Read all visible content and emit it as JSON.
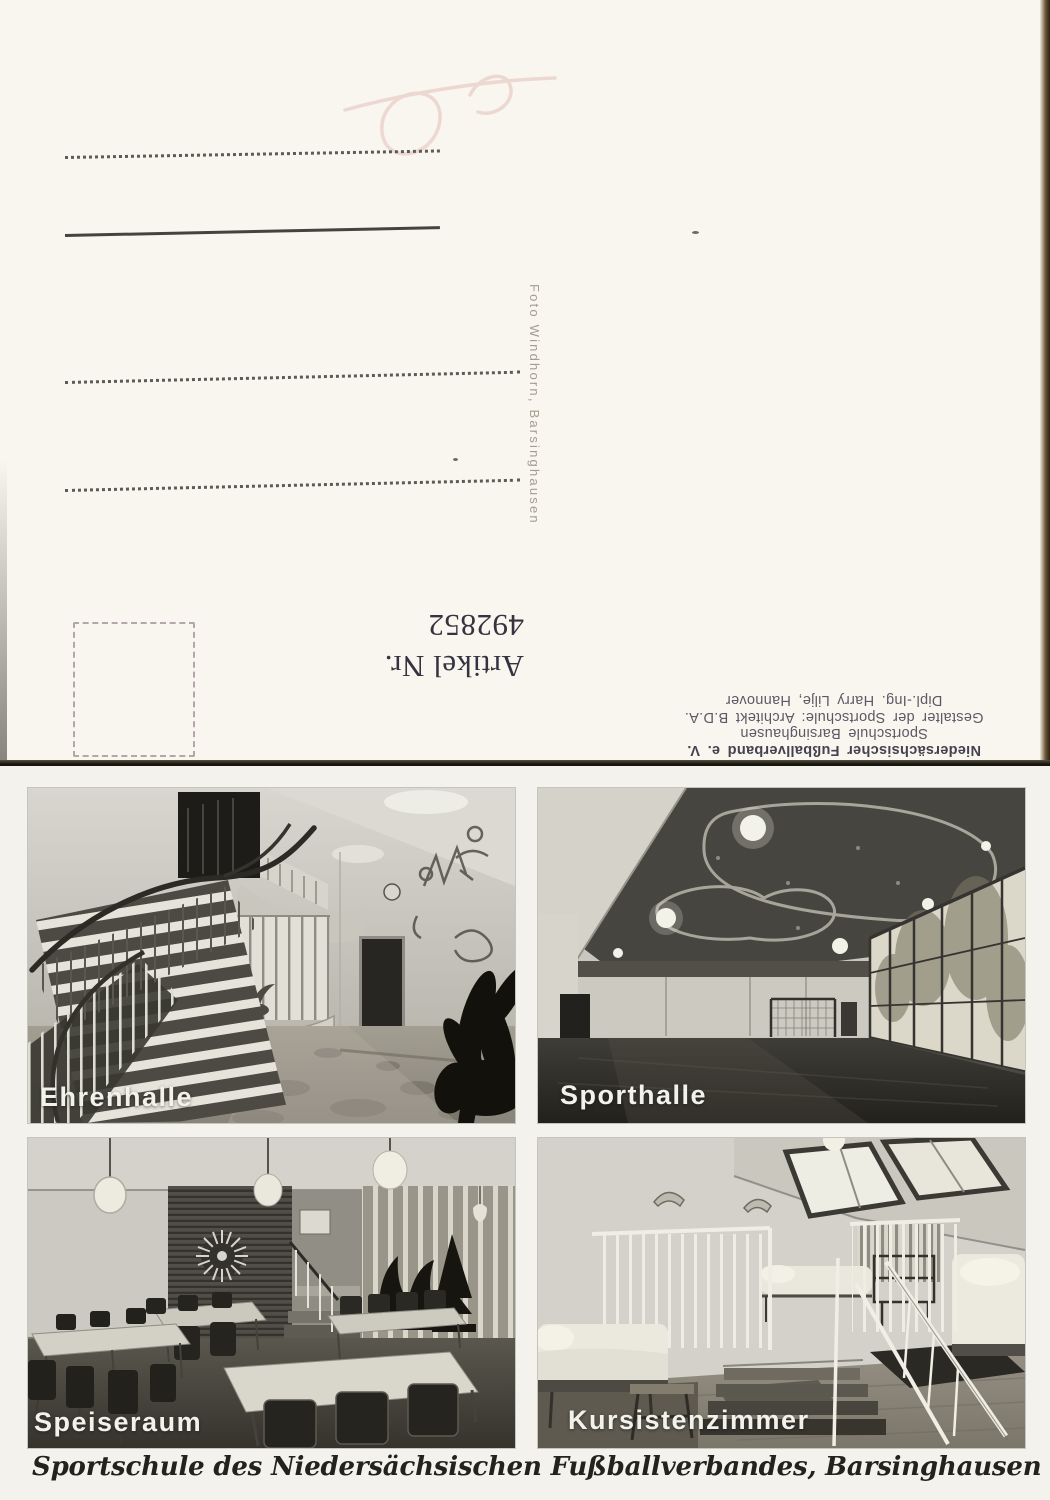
{
  "postcard_back": {
    "photographer_credit": "Foto Windhorn, Barsinghausen",
    "article_label": "Artikel Nr.",
    "article_number": "492852",
    "publisher_block": {
      "line1": "Niedersächsischer Fußballverband e. V.",
      "line2": "Sportschule Barsinghausen",
      "line3": "Gestalter der Sportschule: Architekt B.D.A.",
      "line4": "Dipl.-Ing. Harry Lilje, Hannover"
    }
  },
  "postcard_front": {
    "photos": [
      {
        "id": "ehrenhalle",
        "label": "Ehrenhalle"
      },
      {
        "id": "sporthalle",
        "label": "Sporthalle"
      },
      {
        "id": "speiseraum",
        "label": "Speiseraum"
      },
      {
        "id": "kursistenzimmer",
        "label": "Kursistenzimmer"
      }
    ],
    "caption": "Sportschule des Niedersächsischen Fußballverbandes, Barsinghausen"
  },
  "colors": {
    "card_back_bg": "#f8f6ef",
    "card_front_bg": "#f4f2ec",
    "ink_dark": "#34333f",
    "ink_small": "#5e5865",
    "credit_gray": "#a49e8f",
    "photo_caption_white": "#f2f1ea",
    "scan_edge_brown": "#6a5536"
  }
}
